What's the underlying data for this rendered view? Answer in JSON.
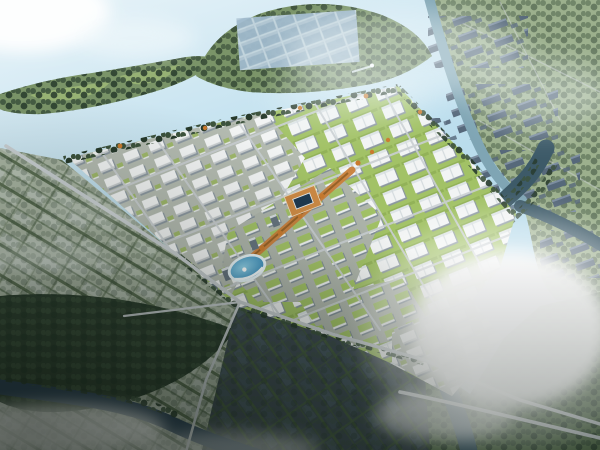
{
  "scene": {
    "type": "aerial-3d-render",
    "subject": "bird's-eye architectural rendering of a planned industrial park",
    "regions": [
      "upper-bay-water",
      "wooded-island",
      "fishpond-peninsula",
      "boat",
      "northeast-farm-land",
      "shed-clusters",
      "east-river",
      "south-river",
      "west-farmland",
      "south-forest",
      "south-paddies",
      "southeast-green-land",
      "industrial-park",
      "park-roads",
      "central-axis",
      "courtyard-ring-building",
      "circular-pond-plaza",
      "perimeter-trees",
      "boundary-roads",
      "clouds",
      "vignette"
    ],
    "no_visible_text": true
  },
  "palette": {
    "skyHaze": "#e4f1f7",
    "waterLight": "#bedfee",
    "waterMid": "#9ccbdf",
    "riverDark": "#3d5a68",
    "riverHazy": "#7fa5b4",
    "riverSouth": "#2c4256",
    "islandGreen": "#7a9468",
    "meadow": "#9db877",
    "treeDark": "#3c523c",
    "treeDeep": "#273a2b",
    "landNE": "#9cb08d",
    "landSE": "#5a7350",
    "shedDark": "#56687a",
    "fieldLight": "#a9b5a3",
    "fieldHedge": "#52664a",
    "paddyDark": "#3e4a52",
    "paddyHedge": "#465c41",
    "forestDark": "#2e4030",
    "parkGroundA": "#b4bbb1",
    "lawnGreen": "#a2c266",
    "roofWhite": "#f2f4f4",
    "roofShadow": "#8b97a0",
    "facadeGray": "#c7ccce",
    "roadGray": "#c9cfd2",
    "axisOrange": "#c9803b",
    "autumnOrange": "#c97a2e",
    "ringRoof": "#cd8a45",
    "ringCourt": "#1f3950",
    "pondBlue": "#2f83b4",
    "pondRim": "#e8f4f8",
    "tallGray": "#66747f",
    "cloudWhite": "#ffffff",
    "mistWhite": "#f4fafc"
  }
}
